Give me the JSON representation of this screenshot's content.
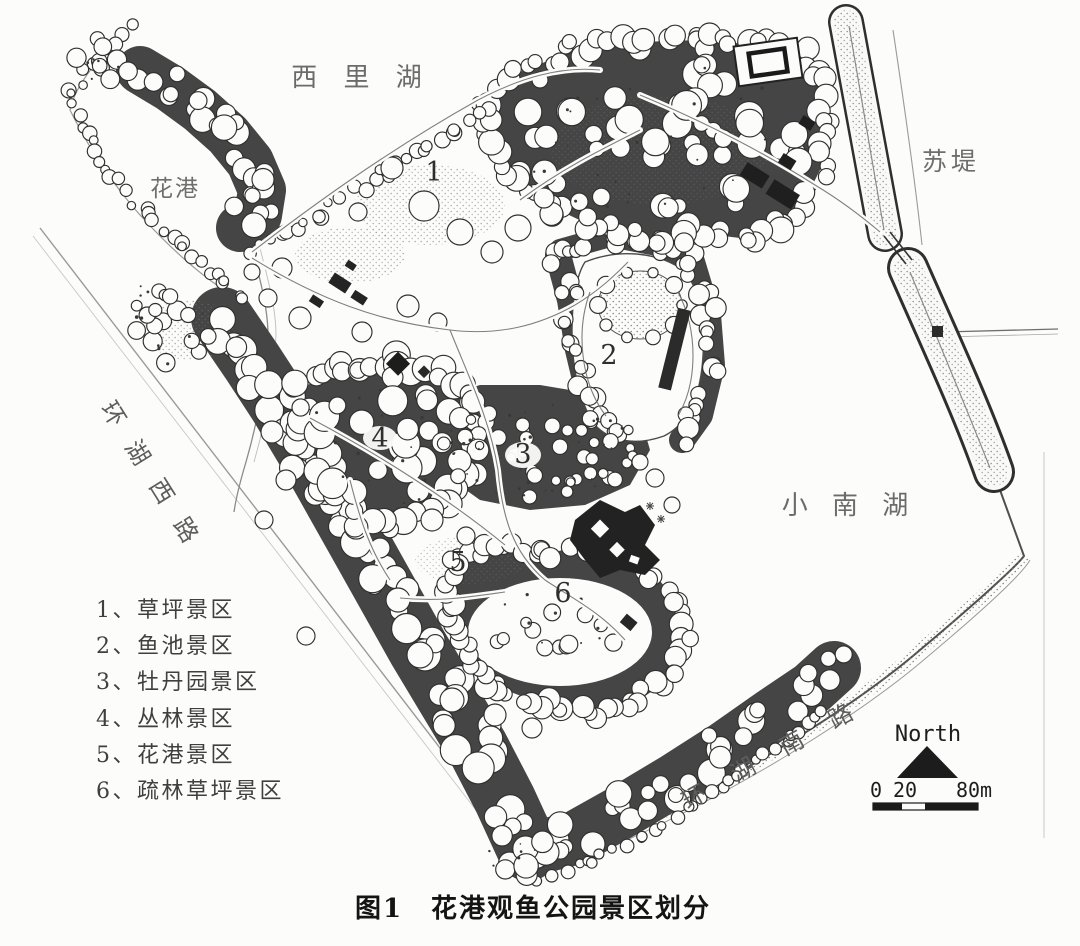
{
  "figure": {
    "caption": "图1　花港观鱼公园景区划分"
  },
  "map": {
    "labels": {
      "xili_lake": "西 里 湖",
      "su_causeway": "苏堤",
      "huagang": "花港",
      "xiaonan_lake": "小 南 湖",
      "ring_lake_west_road": "环 湖 西 路",
      "ring_lake_south_road": "环 湖 南 路"
    },
    "zone_markers": [
      "1",
      "2",
      "3",
      "4",
      "5",
      "6"
    ]
  },
  "legend": {
    "items": [
      "1、草坪景区",
      "2、鱼池景区",
      "3、牡丹园景区",
      "4、丛林景区",
      "5、花港景区",
      "6、疏林草坪景区"
    ]
  },
  "compass": {
    "north_label": "North"
  },
  "scale_bar": {
    "tick_labels": [
      "0",
      "20",
      "80m"
    ]
  },
  "ink_colors": {
    "dark_mass": "#454545",
    "line_ink": "#2f2f2f",
    "paper": "#fcfcfa"
  }
}
